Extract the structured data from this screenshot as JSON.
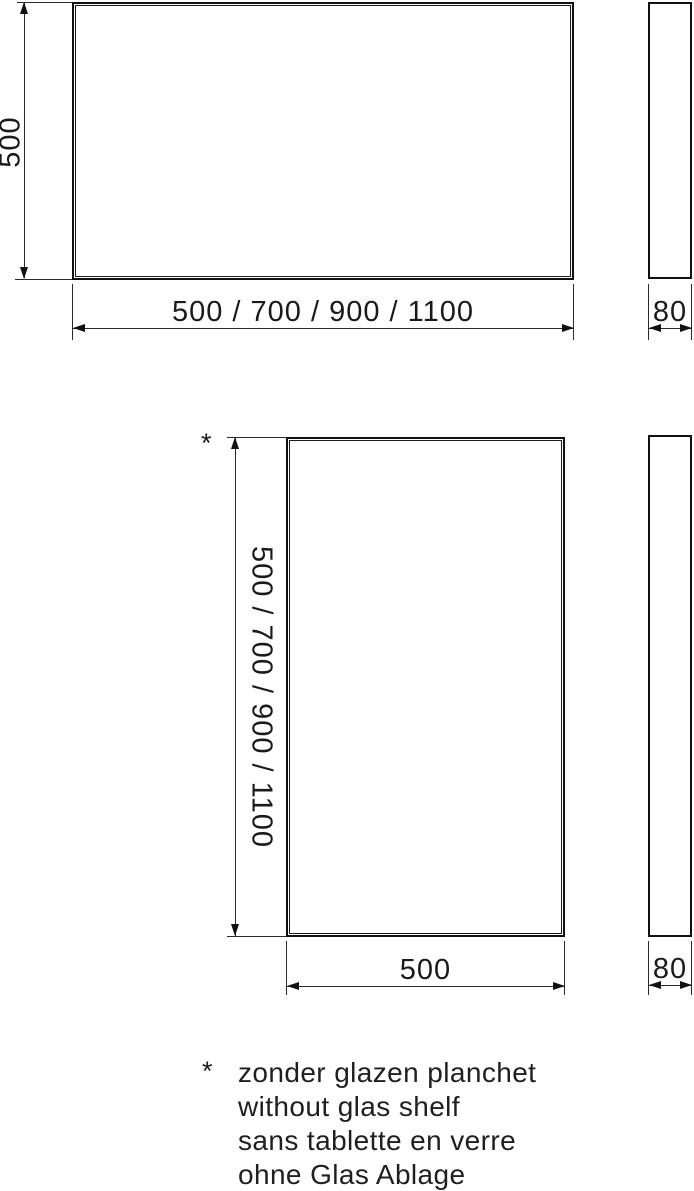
{
  "drawing_top": {
    "height_dim": "500",
    "width_dim": "500 / 700 / 900 / 1100",
    "depth_dim": "80"
  },
  "drawing_bottom": {
    "note_marker": "*",
    "height_dim": "500 / 700 / 900 / 1100",
    "width_dim": "500",
    "depth_dim": "80"
  },
  "footnote": {
    "marker": "*",
    "lines": [
      "zonder glazen planchet",
      "without glas shelf",
      "sans tablette en verre",
      "ohne Glas Ablage"
    ]
  },
  "colors": {
    "line": "#1a1a1a",
    "background": "#ffffff"
  }
}
